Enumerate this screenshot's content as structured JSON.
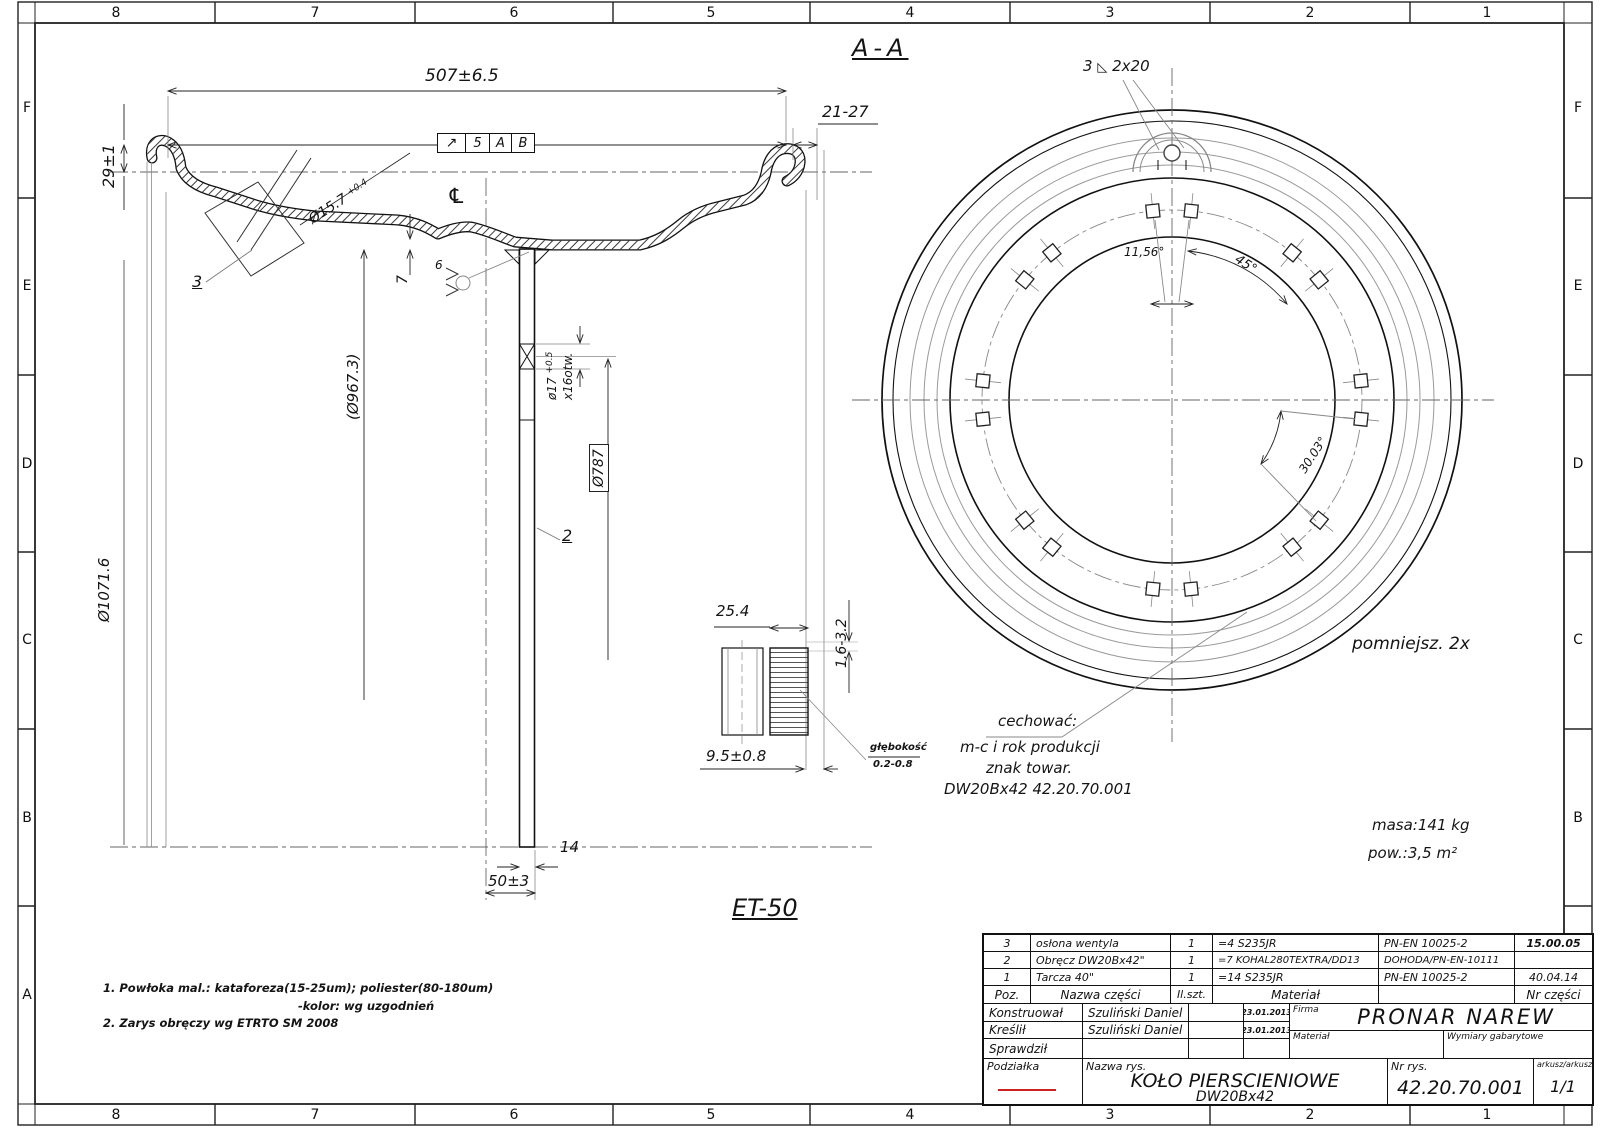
{
  "border": {
    "top": [
      "8",
      "7",
      "6",
      "5",
      "4",
      "3",
      "2",
      "1"
    ],
    "bottom": [
      "8",
      "7",
      "6",
      "5",
      "4",
      "3",
      "2",
      "1"
    ],
    "left": [
      "F",
      "E",
      "D",
      "C",
      "B",
      "A"
    ],
    "right": [
      "F",
      "E",
      "D",
      "C",
      "B",
      "A"
    ]
  },
  "section": {
    "view_label": "A-A",
    "width": "507±6.5",
    "flange_h": "29±1",
    "lip": "21-27",
    "valve_dia": "Ø15.7",
    "valve_tol": "+0.4",
    "rim_dia": "(Ø967.3)",
    "outer_dia": "Ø1071.6",
    "bolt_circle": "Ø787",
    "hole_dia": "ø17",
    "hole_tol": "+0.5",
    "hole_count": "x16otw.",
    "disc_gap": "7",
    "weld_size": "6",
    "disc_thk": "14",
    "offset": "50±3",
    "offset_label": "ET-50",
    "centerline": "℄",
    "balloon_disc": "2",
    "balloon_guard": "3",
    "runout": {
      "symbol": "↗",
      "value": "5",
      "datum1": "A",
      "datum2": "B"
    },
    "detail": {
      "width": "25.4",
      "depth": "9.5±0.8",
      "groove": "1.6-3.2",
      "depth_label": "głębokość",
      "depth_range": "0.2-0.8"
    }
  },
  "front": {
    "weld_note": {
      "pos": "3",
      "symbol": "◺",
      "value": "2x20"
    },
    "angle_pair": "11,56°",
    "angle_spacing": "45°",
    "angle_other": "30.03°",
    "scale_note": "pomniejsz. 2x",
    "marking": {
      "l1": "cechować:",
      "l2": "m-c i rok produkcji",
      "l3": "znak towar.",
      "l4": "DW20Bx42  42.20.70.001"
    },
    "mass": "masa:141 kg",
    "surface": "pow.:3,5 m²"
  },
  "notes": {
    "line1": "1. Powłoka mal.:  kataforeza(15-25um);  poliester(80-180um)",
    "line1b": "-kolor:  wg uzgodnień",
    "line2": "2. Zarys obręczy wg ETRTO SM 2008"
  },
  "title_block": {
    "header": {
      "poz": "Poz.",
      "name": "Nazwa części",
      "qty": "Il.szt.",
      "material": "Materiał",
      "part_no": "Nr części"
    },
    "parts": [
      {
        "poz": "3",
        "name": "osłona wentyla",
        "qty": "1",
        "material": "=4  S235JR",
        "norm": "PN-EN 10025-2",
        "part_no": "15.00.05"
      },
      {
        "poz": "2",
        "name": "Obręcz DW20Bx42\"",
        "qty": "1",
        "material": "=7 KOHAL280TEXTRA/DD13",
        "norm": "DOHODA/PN-EN-10111",
        "part_no": ""
      },
      {
        "poz": "1",
        "name": "Tarcza 40\"",
        "qty": "1",
        "material": "=14 S235JR",
        "norm": "PN-EN 10025-2",
        "part_no": "40.04.14"
      }
    ],
    "roles": [
      {
        "label": "Konstruował",
        "name": "Szuliński Daniel",
        "date": "23.01.2013"
      },
      {
        "label": "Kreślił",
        "name": "Szuliński Daniel",
        "date": "23.01.2013"
      },
      {
        "label": "Sprawdził",
        "name": "",
        "date": ""
      }
    ],
    "firma_label": "Firma",
    "company": "PRONAR NAREW",
    "material_label": "Materiał",
    "dims_label": "Wymiary gabarytowe",
    "scale_label": "Podziałka",
    "name_label": "Nazwa rys.",
    "drawing_name_1": "KOŁO PIERSCIENIOWE",
    "drawing_name_2": "DW20Bx42",
    "number_label": "Nr rys.",
    "drawing_number": "42.20.70.001",
    "sheet_label": "arkusz/arkuszy",
    "sheet_value": "1/1"
  },
  "colors": {
    "line": "#1a1a1a",
    "thin": "#777777",
    "accent_red": "#cc2222"
  }
}
